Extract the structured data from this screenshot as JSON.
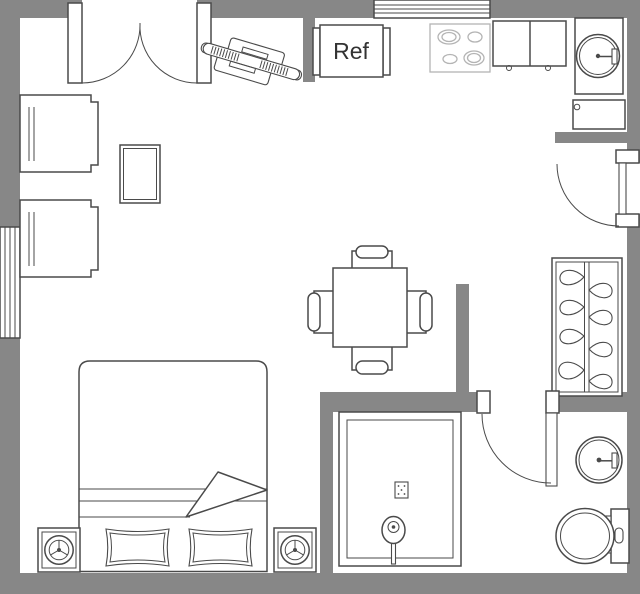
{
  "floorplan": {
    "title": "studio-apartment-floor-plan",
    "labels": {
      "refrigerator": "Ref"
    },
    "colors": {
      "wall": "#878787",
      "line": "#4a4a4a",
      "light_line": "#b4b4b4",
      "floor": "#ffffff",
      "text": "#333333"
    },
    "items": [
      "double-entry-door",
      "top-window",
      "left-window",
      "armchair-top",
      "armchair-bottom",
      "side-table",
      "electronic-keyboard",
      "refrigerator",
      "stove-four-burners",
      "kitchen-counter",
      "kitchen-sink",
      "sink-cabinet",
      "right-entry-door",
      "dining-table-with-four-chairs",
      "plant-shelf",
      "bathroom-door",
      "shower",
      "bathroom-sink",
      "toilet",
      "double-bed-with-two-pillows",
      "speaker-left",
      "speaker-right"
    ]
  }
}
